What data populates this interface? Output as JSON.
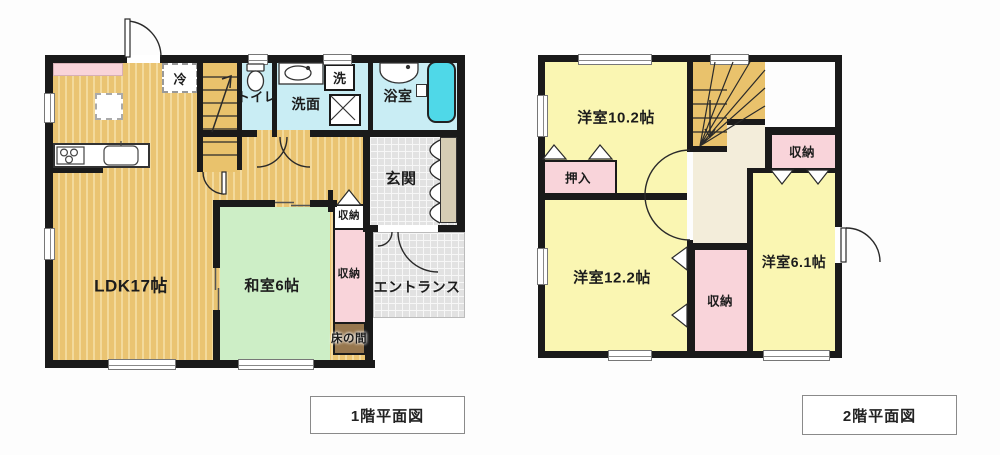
{
  "floor1": {
    "label": "1階平面図",
    "rooms": {
      "ldk": "LDK17帖",
      "washitsu": "和室6帖",
      "toilet": "トイレ",
      "senmen": "洗面",
      "laundry": "洗",
      "bath": "浴室",
      "fridge": "冷",
      "genkan": "玄関",
      "entrance": "エントランス",
      "storage_hall": "収納",
      "storage_washitsu": "収納",
      "tokonoma": "床の間"
    }
  },
  "floor2": {
    "label": "2階平面図",
    "rooms": {
      "west_room_102": "洋室10.2帖",
      "west_room_122": "洋室12.2帖",
      "west_room_61": "洋室6.1帖",
      "oshiire": "押入",
      "storage_ne": "収納",
      "storage_mid": "収納"
    }
  },
  "colors": {
    "wall": "#1a1a1a",
    "wood_floor": "#eac472",
    "wet_room": "#c9edf4",
    "tatami": "#cdeec6",
    "western_room": "#faf6b2",
    "closet_pink": "#f9d4da",
    "tokonoma_brown": "#97774e",
    "tile_gray": "#e2e2e2",
    "hall_cream": "#f3edda",
    "bathtub": "#4fd8e8"
  }
}
